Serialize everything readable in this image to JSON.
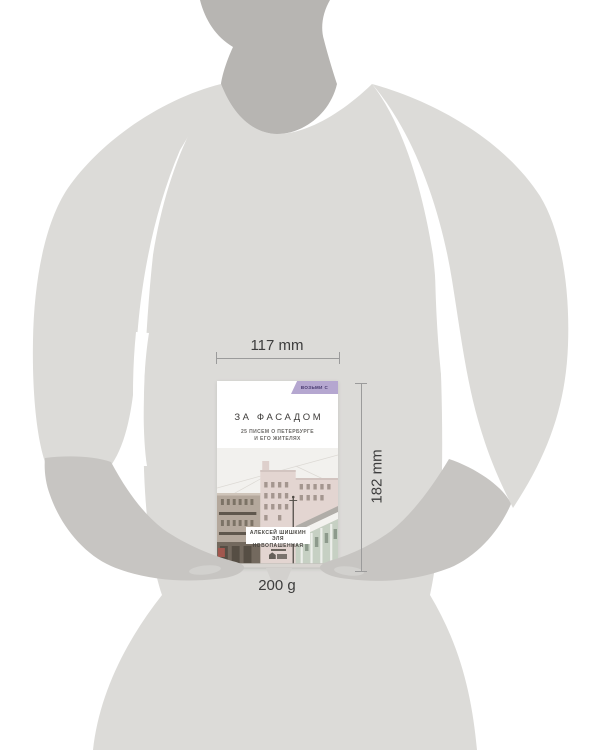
{
  "annotations": {
    "width_label": "117 mm",
    "height_label": "182 mm",
    "weight_label": "200 g"
  },
  "book": {
    "badge": "ВОЗЬМИ С СОБОЙ",
    "title": "ЗА ФАСАДОМ",
    "subtitle_line1": "25 ПИСЕМ О ПЕТЕРБУРГЕ",
    "subtitle_line2": "И ЕГО ЖИТЕЛЯХ",
    "authors_line1": "АЛЕКСЕЙ ШИШКИН",
    "authors_line2": "ЭЛЯ НОВОПАШЕННАЯ"
  },
  "colors": {
    "background": "#ffffff",
    "body": "#dcdbd8",
    "neck": "#b7b5b2",
    "forearm": "#c7c5c2",
    "badge_bg": "#b5a7d0",
    "badge_text": "#43356b",
    "title_text": "#3e3c3a",
    "dimension_text": "#3d3d3d",
    "dimension_line": "#9b9b9b",
    "cover_sky": "#f2f1ee",
    "cover_pink_building": "#e3d5d1",
    "cover_tan_building": "#b4a89c",
    "cover_green_building": "#c6d0c3"
  }
}
